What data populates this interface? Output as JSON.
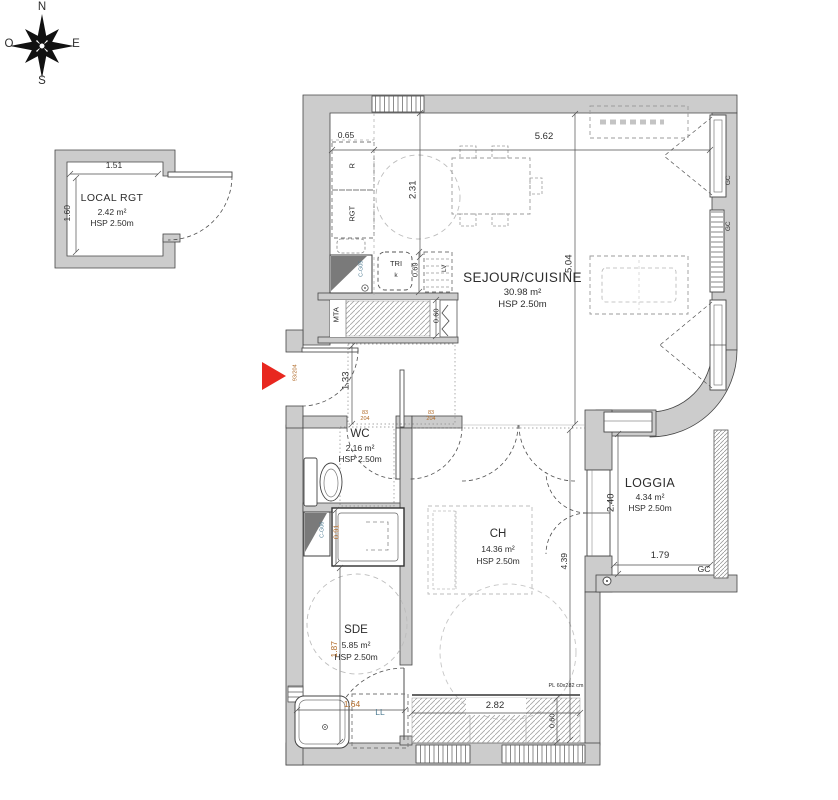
{
  "compass": {
    "n": "N",
    "e": "E",
    "s": "S",
    "o": "O"
  },
  "rooms": {
    "local": {
      "name": "LOCAL RGT",
      "area": "2.42 m²",
      "hsp": "HSP 2.50m"
    },
    "sejour": {
      "name": "SEJOUR/CUISINE",
      "area": "30.98 m²",
      "hsp": "HSP 2.50m"
    },
    "wc": {
      "name": "WC",
      "area": "2.16 m²",
      "hsp": "HSP 2.50m"
    },
    "ch": {
      "name": "CH",
      "area": "14.36 m²",
      "hsp": "HSP 2.50m"
    },
    "sde": {
      "name": "SDE",
      "area": "5.85 m²",
      "hsp": "HSP 2.50m"
    },
    "loggia": {
      "name": "LOGGIA",
      "area": "4.34 m²",
      "hsp": "HSP 2.50m"
    }
  },
  "dims": {
    "local_width": "1.51",
    "local_depth": "1.60",
    "kitchen_counter": "0.65",
    "sejour_width": "5.62",
    "kitchen_length": "2.31",
    "sejour_length": "5.04",
    "appliance_row": "0.69",
    "entry_closet": "0.60",
    "hall_width": "1.33",
    "shower_width": "0.91",
    "sde_length": "1.87",
    "sde_width": "1.64",
    "ch_width": "2.82",
    "ch_closet": "0.60",
    "ch_length": "4.39",
    "loggia_depth": "2.40",
    "loggia_width": "1.79"
  },
  "fixtures": {
    "fridge": "R",
    "storage": "RGT",
    "tri": "TRI",
    "tri_sub": "k",
    "dishwasher": "LV",
    "mta": "MTA",
    "duct_kitchen": "C-G05",
    "duct_sde": "C-G06",
    "washer": "LL",
    "closet_tag": "PL 60x282 cm",
    "railing": "GC"
  },
  "door_tags": {
    "leaf_width": "83",
    "leaf_height": "204",
    "entry": "93/204"
  },
  "colors": {
    "wall_fill": "#cccccc",
    "wall_stroke": "#454545",
    "line": "#4f4f4f",
    "furniture_dash": "#9b9b9b",
    "light_dash": "#bdbdbd",
    "arrow_red": "#e8271f",
    "label_blue": "#4e7b92",
    "label_orange": "#b06a28"
  }
}
